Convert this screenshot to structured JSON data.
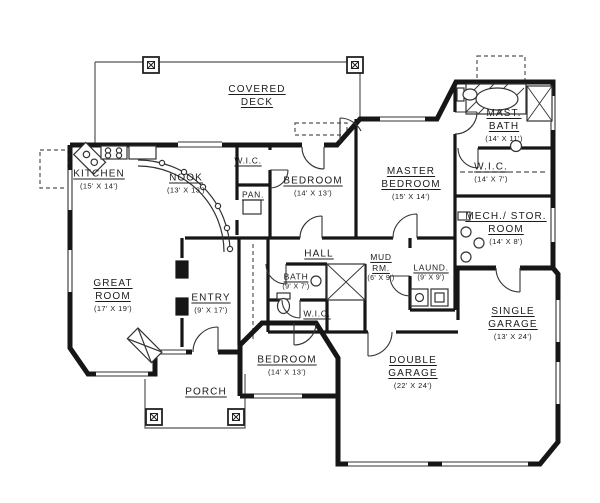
{
  "drawing": {
    "title": "Residential Floor Plan",
    "colors": {
      "ink": "#1a1a1a",
      "paper": "#ffffff",
      "thin_line": "#555555"
    }
  },
  "rooms": [
    {
      "id": "covered-deck",
      "name": "COVERED\nDECK"
    },
    {
      "id": "kitchen",
      "name": "KITCHEN",
      "dims": "(15' X 14')"
    },
    {
      "id": "nook",
      "name": "NOOK",
      "dims": "(13' X 13')"
    },
    {
      "id": "wic-top",
      "name": "W.I.C."
    },
    {
      "id": "pantry",
      "name": "PAN."
    },
    {
      "id": "bedroom-top",
      "name": "BEDROOM",
      "dims": "(14' X 13')"
    },
    {
      "id": "master-bedroom",
      "name": "MASTER\nBEDROOM",
      "dims": "(15' X 14')"
    },
    {
      "id": "master-bath",
      "name": "MAST.\nBATH",
      "dims": "(14' X 11')"
    },
    {
      "id": "wic-master",
      "name": "W.I.C.",
      "dims": "(14' X 7')"
    },
    {
      "id": "mech-stor",
      "name": "MECH./ STOR.\nROOM",
      "dims": "(14' X 8')"
    },
    {
      "id": "great-room",
      "name": "GREAT\nROOM",
      "dims": "(17' X 19')"
    },
    {
      "id": "entry",
      "name": "ENTRY",
      "dims": "(9' X 17')"
    },
    {
      "id": "hall",
      "name": "HALL"
    },
    {
      "id": "bath",
      "name": "BATH",
      "dims": "(9' X 7')"
    },
    {
      "id": "wic-hall",
      "name": "W.I.C."
    },
    {
      "id": "mud-room",
      "name": "MUD\nRM.",
      "dims": "(6' X 9')"
    },
    {
      "id": "laundry",
      "name": "LAUND.",
      "dims": "(9' X 9')"
    },
    {
      "id": "single-garage",
      "name": "SINGLE\nGARAGE",
      "dims": "(13' X 24')"
    },
    {
      "id": "bedroom-bottom",
      "name": "BEDROOM",
      "dims": "(14' X 13')"
    },
    {
      "id": "double-garage",
      "name": "DOUBLE\nGARAGE",
      "dims": "(22' X 24')"
    },
    {
      "id": "porch",
      "name": "PORCH"
    }
  ]
}
